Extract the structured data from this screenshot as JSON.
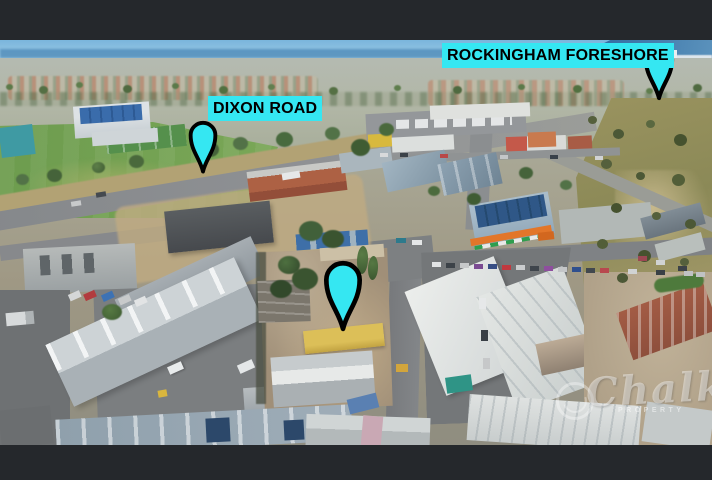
{
  "canvas": {
    "letterbox_color": "#25282c"
  },
  "annotations": {
    "accent_color": "#35e7f2",
    "pin_outline_color": "#000000",
    "label_text_color": "#000000",
    "foreshore_label": "ROCKINGHAM FORESHORE",
    "dixon_label": "DIXON ROAD",
    "pins": [
      {
        "name": "rockingham-foreshore-pin"
      },
      {
        "name": "dixon-road-pin"
      },
      {
        "name": "subject-property-pin"
      }
    ]
  },
  "watermark": {
    "brand": "Chalk",
    "subtext": "PROPERTY"
  }
}
